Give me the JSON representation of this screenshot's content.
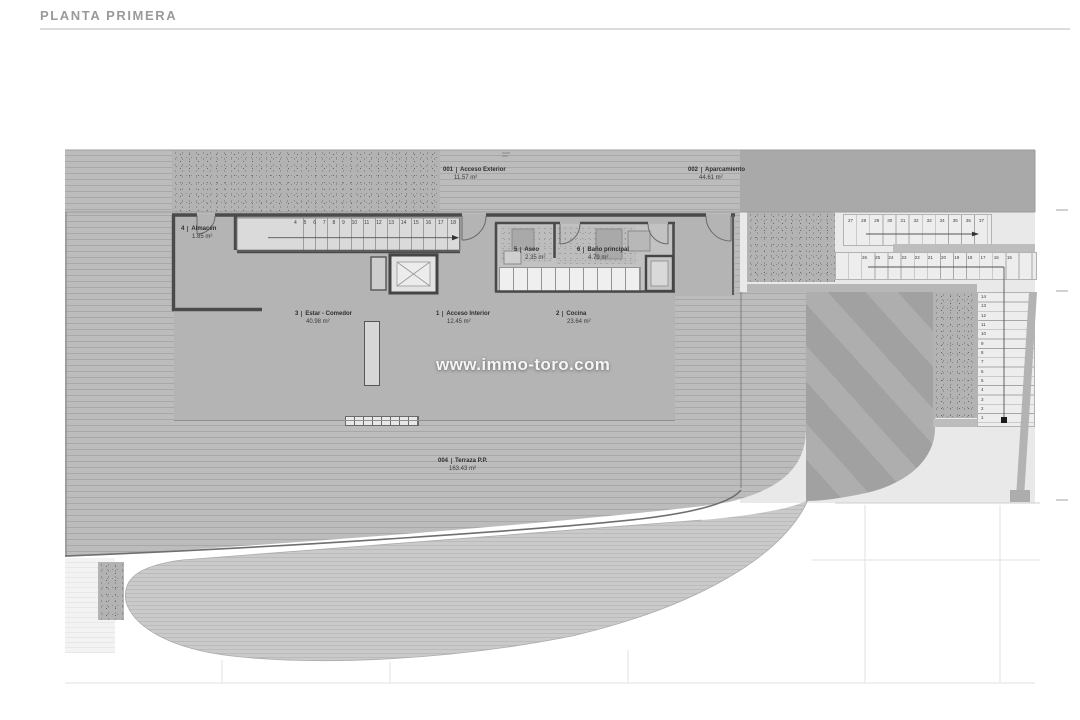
{
  "page": {
    "title": "PLANTA PRIMERA"
  },
  "watermark": "www.immo-toro.com",
  "rooms": [
    {
      "id": "001",
      "name": "Acceso Exterior",
      "area": "11.57 m²"
    },
    {
      "id": "002",
      "name": "Aparcamiento",
      "area": "44.61 m²"
    },
    {
      "id": "4",
      "name": "Almacén",
      "area": "1.85 m²"
    },
    {
      "id": "5",
      "name": "Aseo",
      "area": "2.35 m²"
    },
    {
      "id": "6",
      "name": "Baño principal",
      "area": "4.79 m²"
    },
    {
      "id": "3",
      "name": "Estar - Comedor",
      "area": "40.98 m²"
    },
    {
      "id": "1",
      "name": "Acceso Interior",
      "area": "12.45 m²"
    },
    {
      "id": "2",
      "name": "Cocina",
      "area": "23.64 m²"
    },
    {
      "id": "004",
      "name": "Terraza P.P.",
      "area": "163.43 m²"
    }
  ],
  "stairs": {
    "interior": {
      "numbers": [
        "4",
        "5",
        "6",
        "7",
        "8",
        "9",
        "10",
        "11",
        "12",
        "13",
        "14",
        "15",
        "16",
        "17",
        "18"
      ]
    },
    "exterior_upper": {
      "numbers": [
        "27",
        "28",
        "29",
        "30",
        "31",
        "32",
        "33",
        "34",
        "35",
        "36",
        "37"
      ]
    },
    "exterior_lower": {
      "numbers": [
        "26",
        "25",
        "24",
        "23",
        "22",
        "21",
        "20",
        "19",
        "18",
        "17",
        "16",
        "15"
      ]
    },
    "exterior_vertical": {
      "numbers": [
        "14",
        "13",
        "12",
        "11",
        "10",
        "9",
        "8",
        "7",
        "6",
        "5",
        "4",
        "3",
        "2",
        "1"
      ]
    }
  },
  "colors": {
    "deck_stripe": "#bcbcbc",
    "garden_stripe": "#cacaca",
    "wall": "#4a4a4a",
    "band": "#a9a9a9",
    "ramp": "#a1a1a1",
    "title_text": "#9a9a9a",
    "watermark_text": "#ffffff"
  }
}
